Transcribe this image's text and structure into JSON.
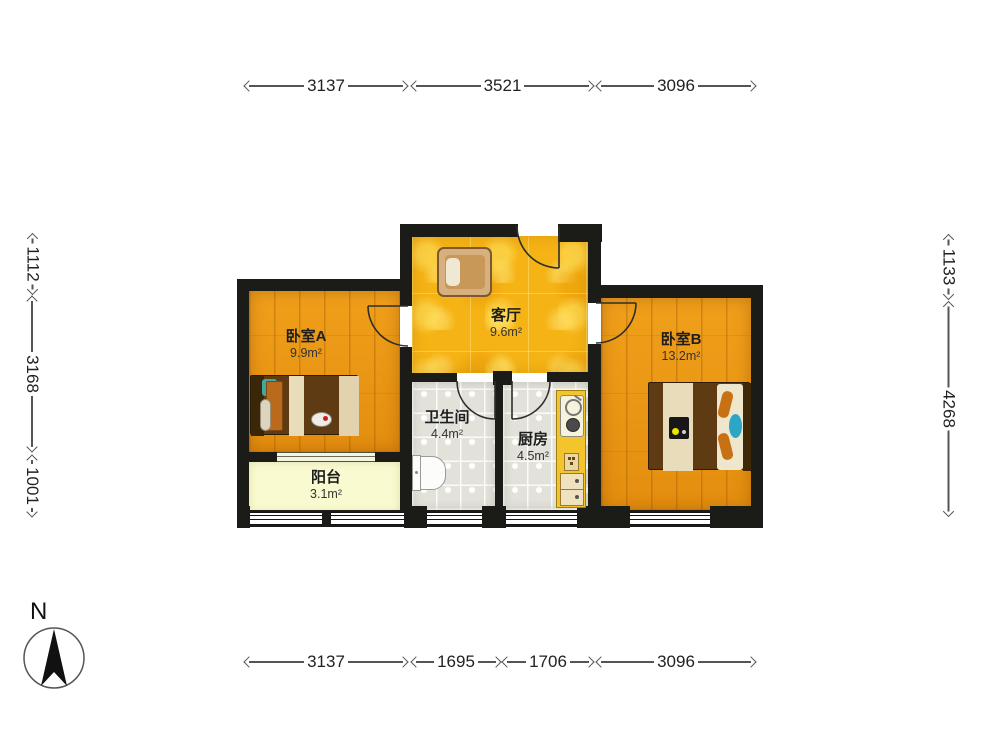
{
  "title": "two-bedroom apartment floor plan",
  "compass": {
    "label": "N"
  },
  "dimensions": {
    "top": [
      "3137",
      "3521",
      "3096"
    ],
    "bottom": [
      "3137",
      "1695",
      "1706",
      "3096"
    ],
    "left": [
      "1112",
      "3168",
      "1001"
    ],
    "right": [
      "1133",
      "4268"
    ]
  },
  "rooms": [
    {
      "id": "bedroom-a",
      "name": "卧室A",
      "area": "9.9m²"
    },
    {
      "id": "living-room",
      "name": "客厅",
      "area": "9.6m²"
    },
    {
      "id": "bedroom-b",
      "name": "卧室B",
      "area": "13.2m²"
    },
    {
      "id": "bathroom",
      "name": "卫生间",
      "area": "4.4m²"
    },
    {
      "id": "kitchen",
      "name": "厨房",
      "area": "4.5m²"
    },
    {
      "id": "balcony",
      "name": "阳台",
      "area": "3.1m²"
    }
  ],
  "colors": {
    "wall": "#1B1B17",
    "bedroom_floor": "#ED9711",
    "living_floor": "#F5B315",
    "tile_floor": "#E2E2DA",
    "balcony_floor": "#FAFAD0",
    "kitchen_counter": "#F3C42C",
    "accent_teal": "#2BA6C4",
    "dimension_line": "#555555"
  }
}
